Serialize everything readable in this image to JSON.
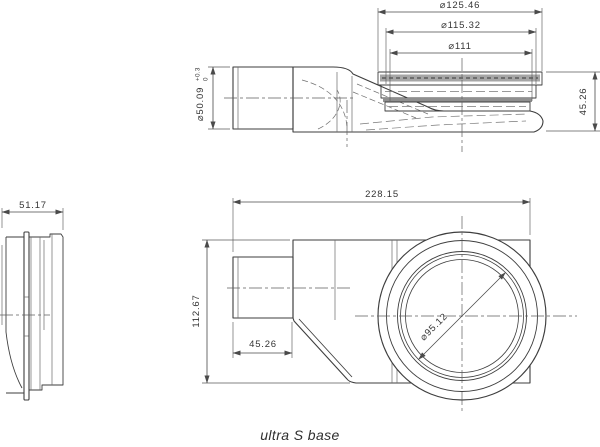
{
  "page": {
    "background": "#ffffff",
    "caption": "ultra S base"
  },
  "drawing": {
    "side_view": {
      "outlet_diameter": "⌀50.09",
      "outlet_tolerance_upper": "+0.3",
      "outlet_tolerance_lower": "0",
      "grate_diameter": "⌀125.46",
      "flange_diameter": "⌀115.32",
      "insert_diameter": "⌀111",
      "height": "45.26"
    },
    "end_view": {
      "depth": "51.17"
    },
    "plan_view": {
      "overall_length": "228.15",
      "overall_width": "112.67",
      "outlet_stub_length": "45.26",
      "bowl_diameter": "⌀95.12"
    },
    "colors": {
      "line": "#3e3e3e",
      "dim_line": "#4a4a4a",
      "text": "#343434",
      "grate_fill": "#a6a6a6",
      "grate_hatch": "#5c5c5c",
      "seal_fill": "#8f8f8f"
    }
  }
}
